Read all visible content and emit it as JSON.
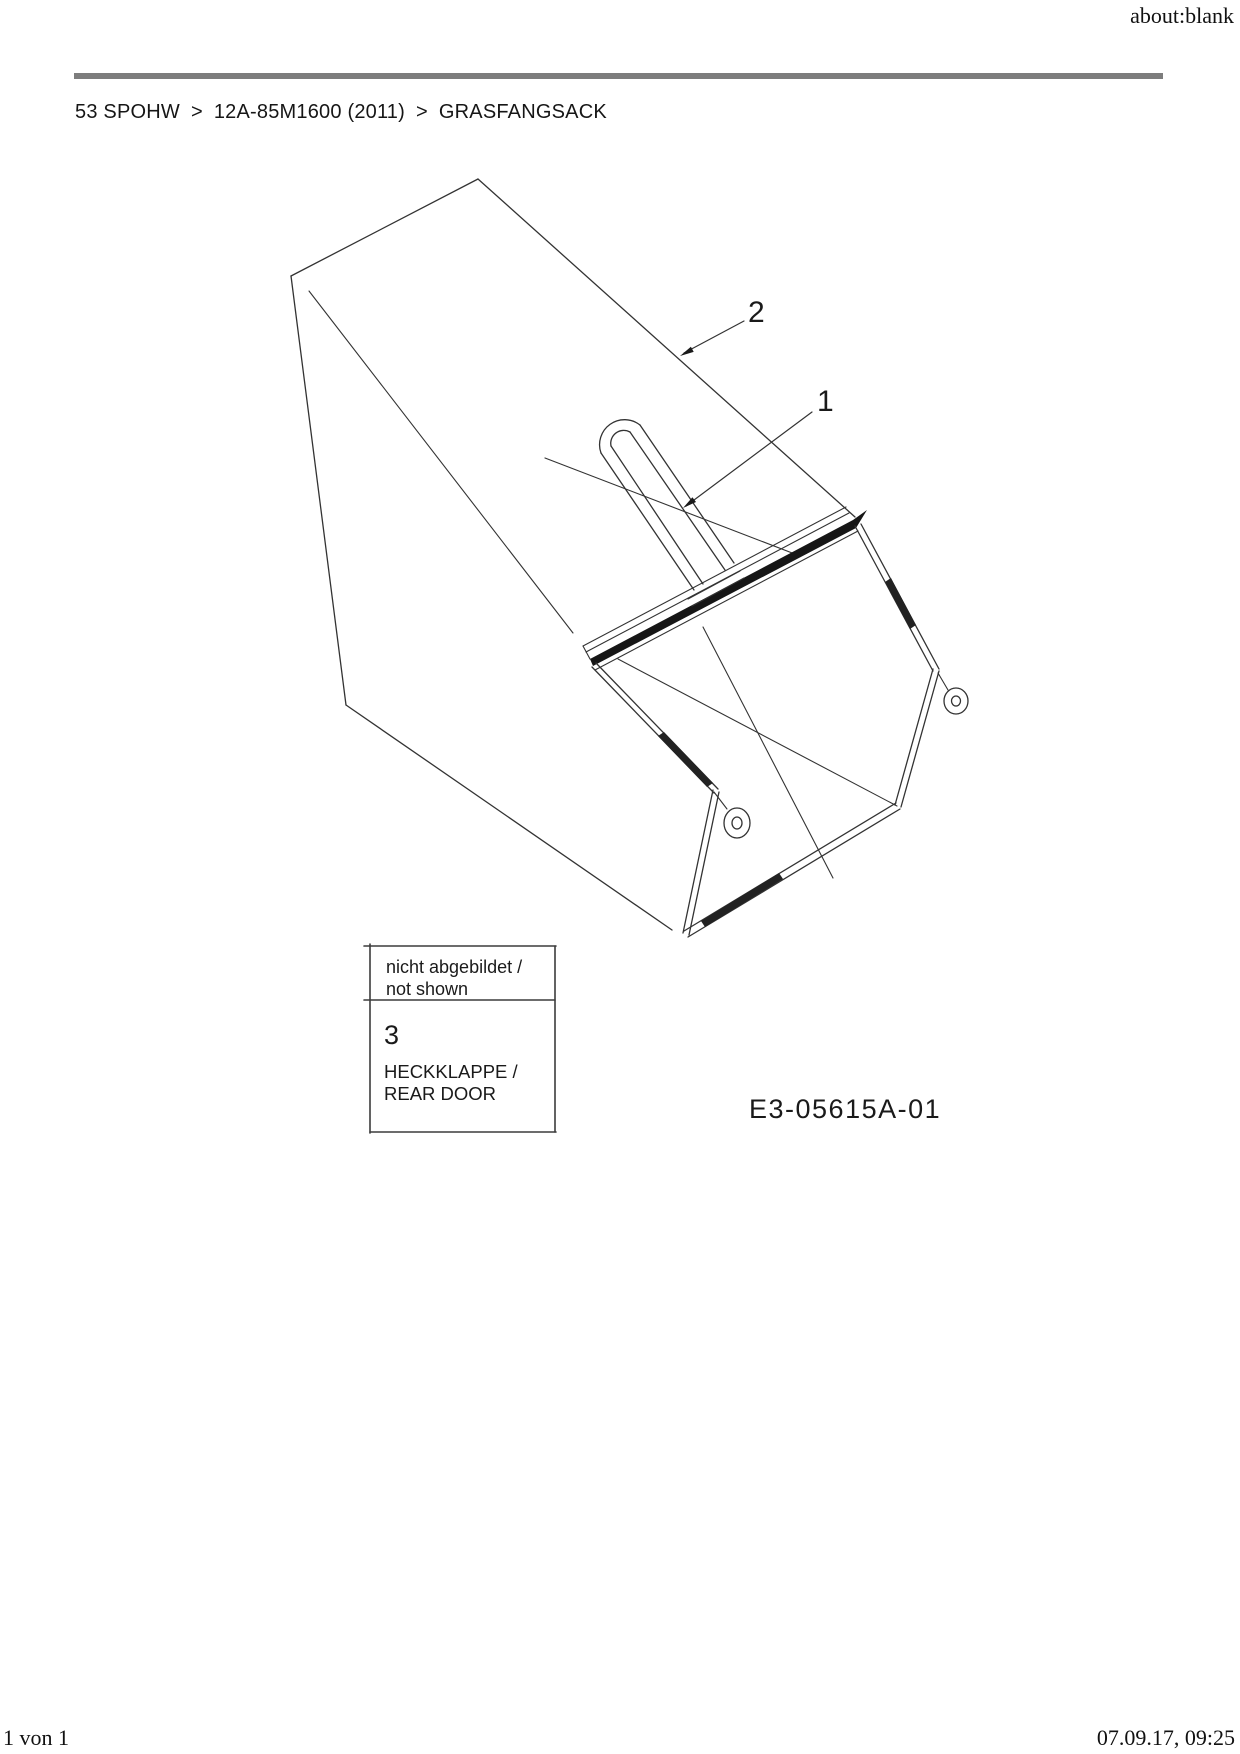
{
  "header": {
    "url": "about:blank"
  },
  "breadcrumb": {
    "separator": ">",
    "items": [
      "53 SPOHW",
      "12A-85M1600 (2011)",
      "GRASFANGSACK"
    ]
  },
  "diagram": {
    "title": "GRASFANGSACK",
    "part_labels": [
      {
        "number": "2"
      },
      {
        "number": "1"
      }
    ],
    "callout_box": {
      "not_shown_de": "nicht abgebildet /",
      "not_shown_en": "not shown",
      "item_number": "3",
      "part_name_de": "HECKKLAPPE /",
      "part_name_en": "REAR DOOR"
    },
    "drawing_number": "E3-05615A-01",
    "colors": {
      "line": "#333333",
      "crossbar_fill": "#161616",
      "divider_bar": "#7d7d7d"
    }
  },
  "footer": {
    "page_info": "1 von 1",
    "timestamp": "07.09.17, 09:25"
  }
}
